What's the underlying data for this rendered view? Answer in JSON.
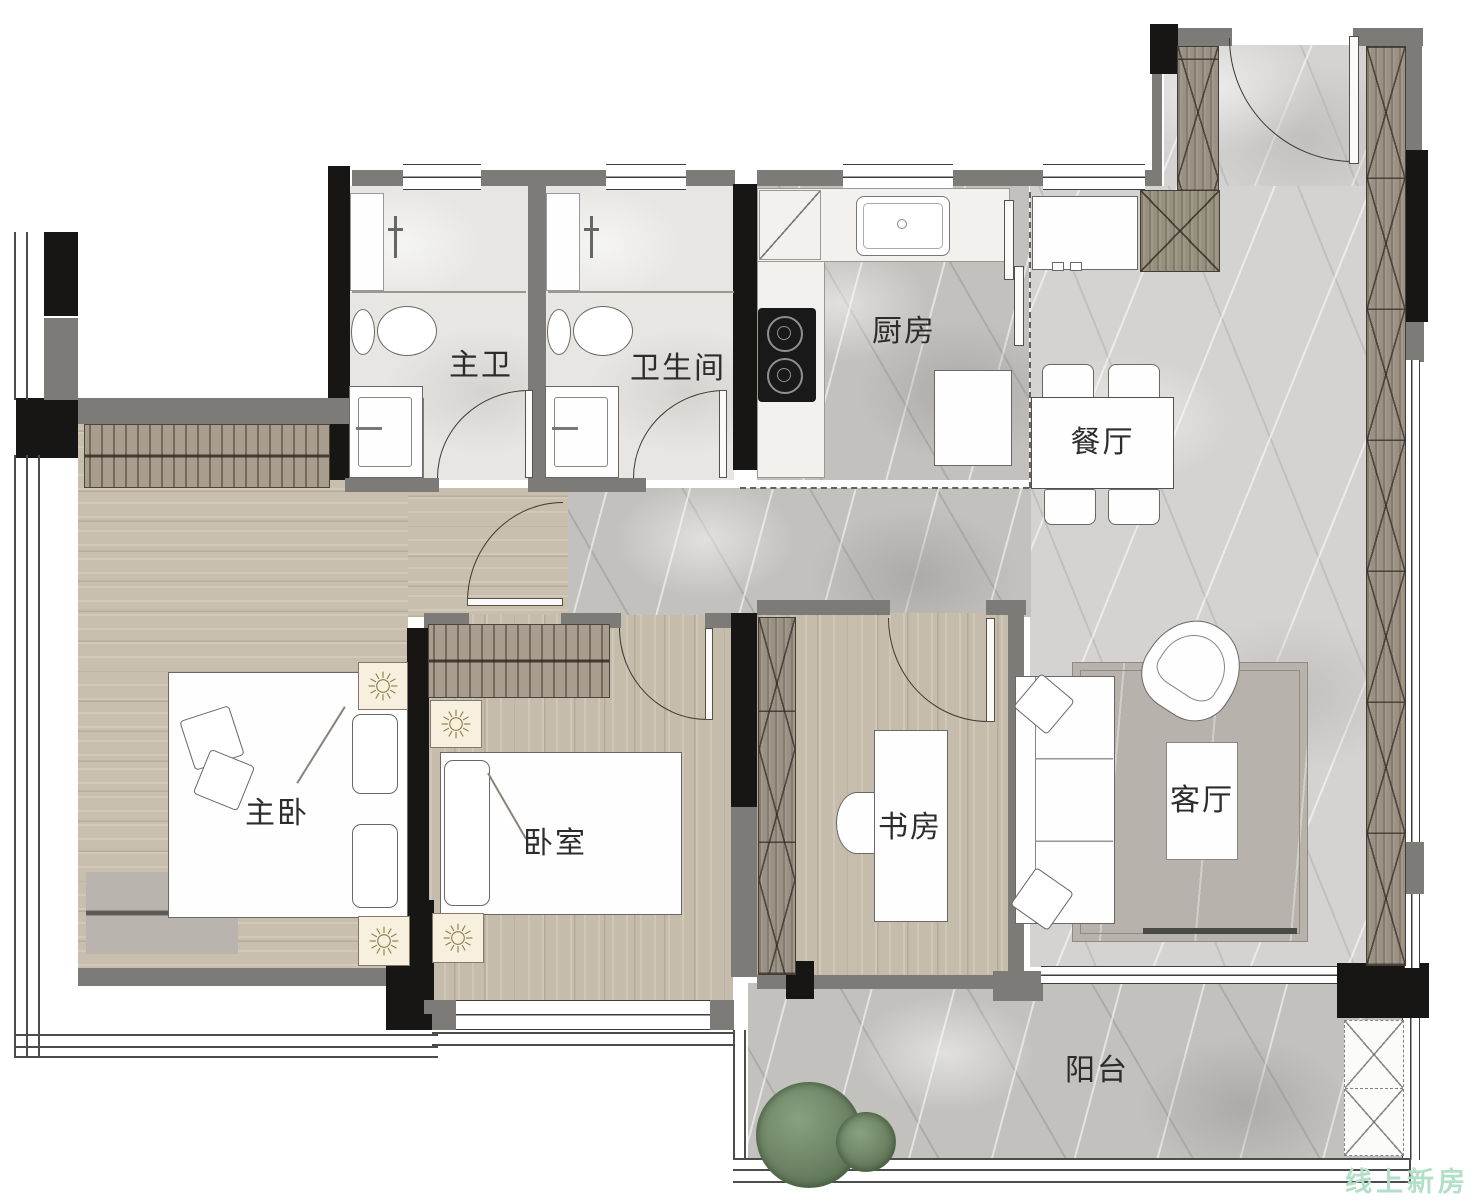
{
  "rooms": {
    "master_bath": {
      "label": "主卫"
    },
    "bathroom": {
      "label": "卫生间"
    },
    "kitchen": {
      "label": "厨房"
    },
    "dining": {
      "label": "餐厅"
    },
    "master_bedroom": {
      "label": "主卧"
    },
    "bedroom": {
      "label": "卧室"
    },
    "study": {
      "label": "书房"
    },
    "living": {
      "label": "客厅"
    },
    "balcony": {
      "label": "阳台"
    }
  },
  "watermark": {
    "text": "线上新房",
    "color": "#b2dfc8"
  },
  "icons": [
    "toilet-icon",
    "sink-icon",
    "shower-valve-icon",
    "stove-icon",
    "kitchen-sink-icon",
    "fridge-icon",
    "lamp-sunburst-icon",
    "plant-icon",
    "door-arc-icon",
    "wardrobe-hangers-icon"
  ],
  "colors": {
    "wall_gray": "#7d7b78",
    "wall_dark": "#171614",
    "wood_floor": "#c9bfae",
    "marble_light": "#d4d3d1",
    "marble_mid": "#c2c1be",
    "cabinet_wood": "#9a9083",
    "plant_green": "#6c8263",
    "lamp_cream": "#f8f0de"
  }
}
